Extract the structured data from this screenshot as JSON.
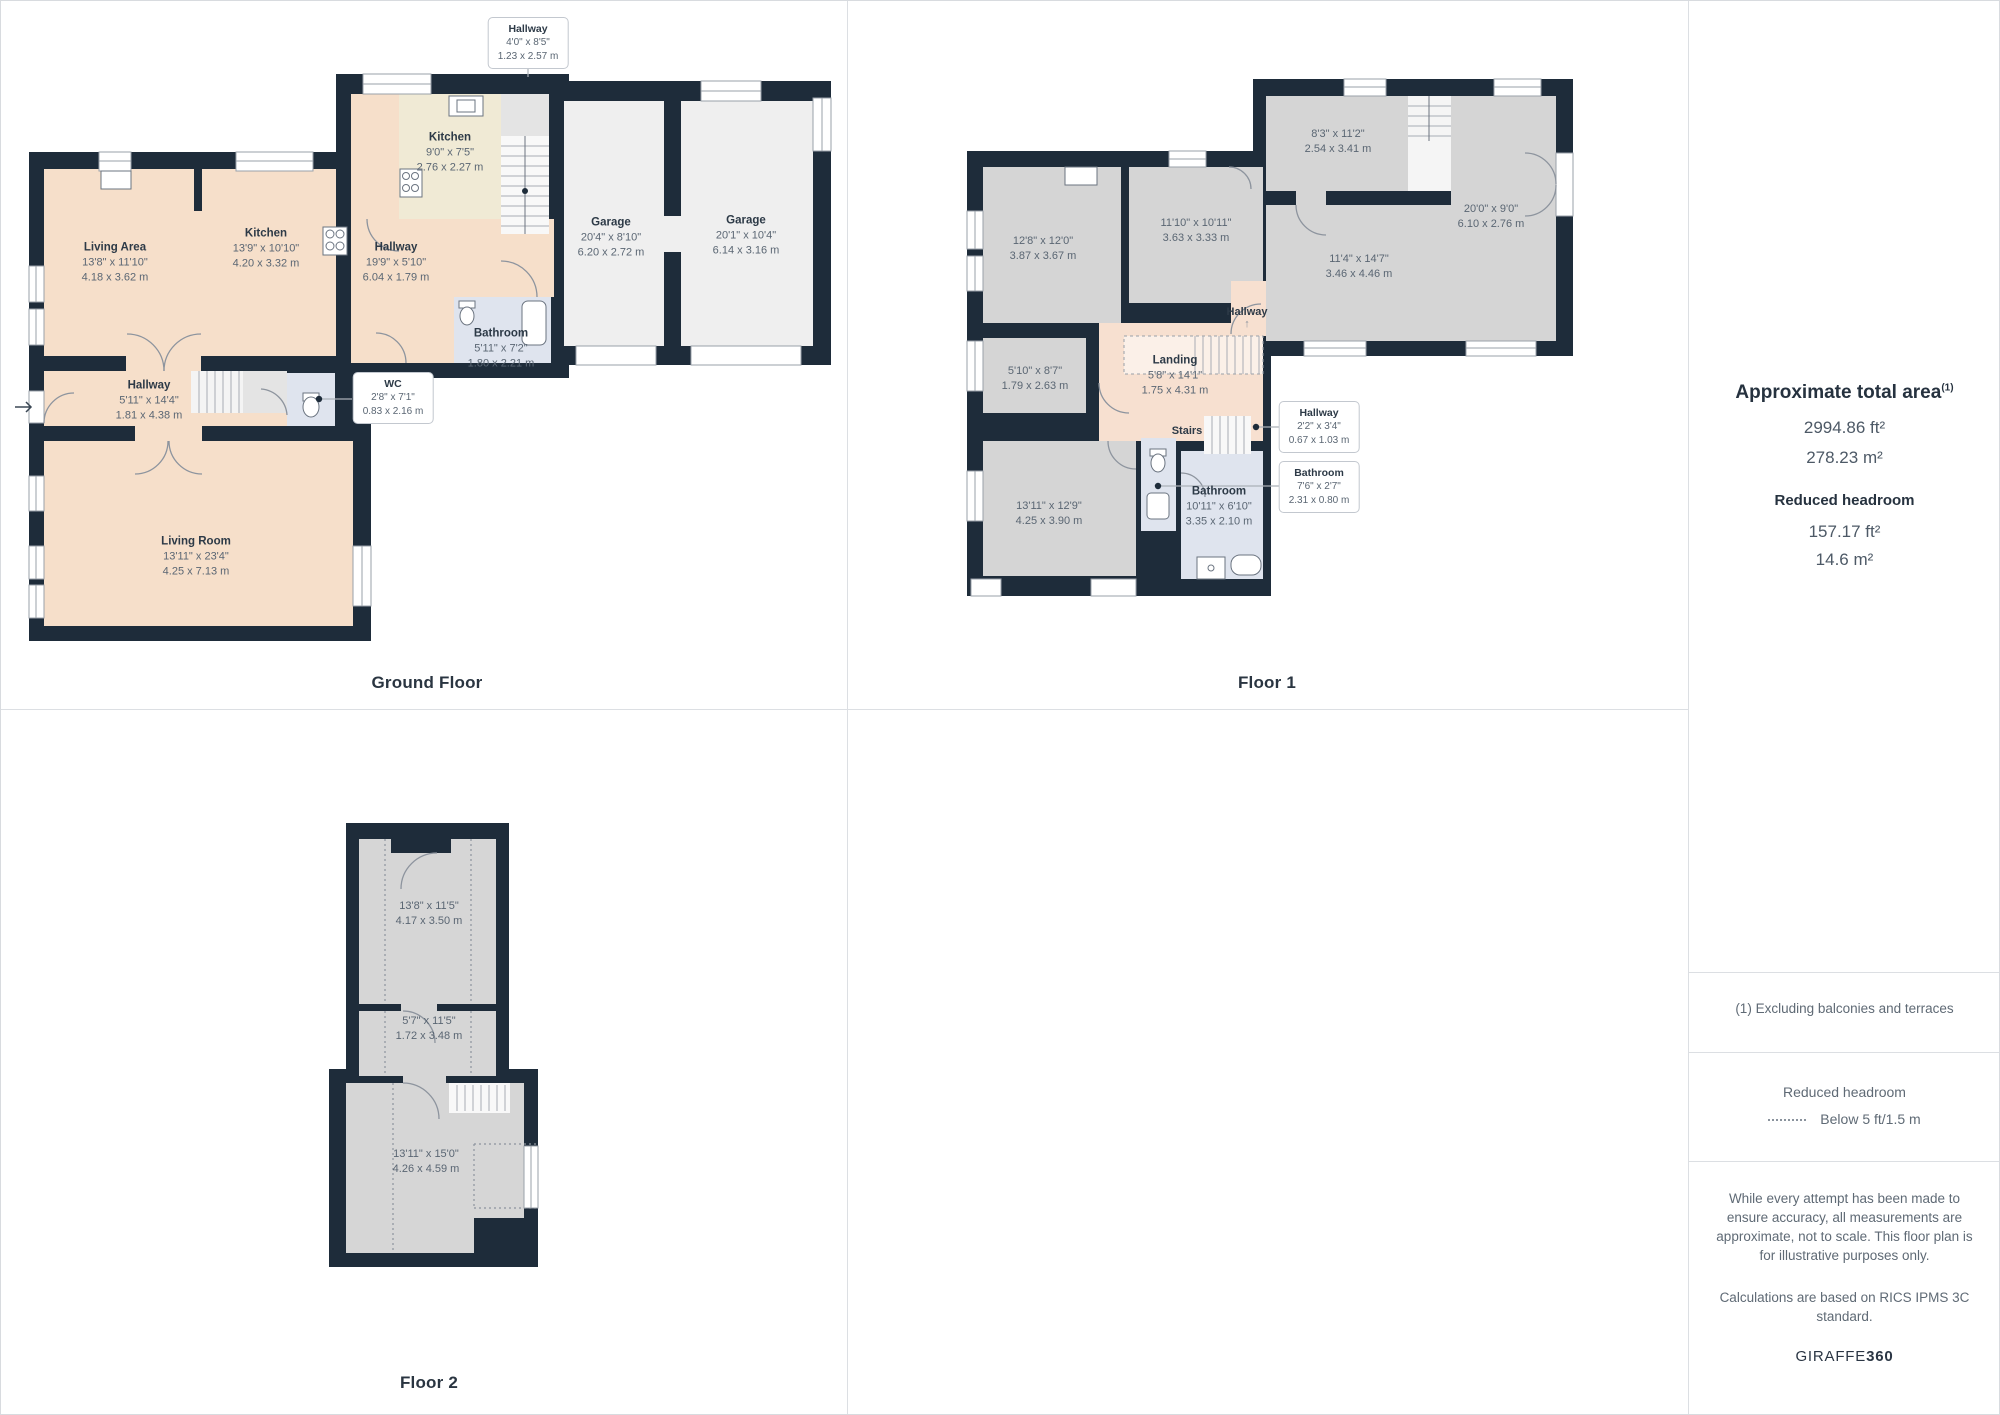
{
  "floors": {
    "ground": {
      "title": "Ground Floor",
      "rooms": [
        {
          "name": "Living Area",
          "ft": "13'8\" x 11'10\"",
          "m": "4.18 x 3.62 m"
        },
        {
          "name": "Kitchen",
          "ft": "13'9\" x 10'10\"",
          "m": "4.20 x 3.32 m"
        },
        {
          "name": "Kitchen",
          "ft": "9'0\" x 7'5\"",
          "m": "2.76 x 2.27 m"
        },
        {
          "name": "Hallway",
          "ft": "19'9\" x 5'10\"",
          "m": "6.04 x 1.79 m"
        },
        {
          "name": "Garage",
          "ft": "20'4\" x 8'10\"",
          "m": "6.20 x 2.72 m"
        },
        {
          "name": "Garage",
          "ft": "20'1\" x 10'4\"",
          "m": "6.14 x 3.16 m"
        },
        {
          "name": "Bathroom",
          "ft": "5'11\" x 7'2\"",
          "m": "1.80 x 2.21 m"
        },
        {
          "name": "Hallway",
          "ft": "5'11\" x 14'4\"",
          "m": "1.81 x 4.38 m"
        },
        {
          "name": "Living Room",
          "ft": "13'11\" x 23'4\"",
          "m": "4.25 x 7.13 m"
        }
      ],
      "callouts": [
        {
          "name": "Hallway",
          "ft": "4'0\" x 8'5\"",
          "m": "1.23 x 2.57 m"
        },
        {
          "name": "WC",
          "ft": "2'8\" x 7'1\"",
          "m": "0.83 x 2.16 m"
        }
      ]
    },
    "floor1": {
      "title": "Floor 1",
      "rooms": [
        {
          "ft": "12'8\" x 12'0\"",
          "m": "3.87 x 3.67 m"
        },
        {
          "ft": "11'10\" x 10'11\"",
          "m": "3.63 x 3.33 m"
        },
        {
          "ft": "8'3\" x 11'2\"",
          "m": "2.54 x 3.41 m"
        },
        {
          "ft": "20'0\" x 9'0\"",
          "m": "6.10 x 2.76 m"
        },
        {
          "ft": "11'4\" x 14'7\"",
          "m": "3.46 x 4.46 m"
        },
        {
          "ft": "5'10\" x 8'7\"",
          "m": "1.79 x 2.63 m"
        },
        {
          "name": "Landing",
          "ft": "5'8\" x 14'1\"",
          "m": "1.75 x 4.31 m"
        },
        {
          "ft": "13'11\" x 12'9\"",
          "m": "4.25 x 3.90 m"
        },
        {
          "name": "Bathroom",
          "ft": "10'11\" x 6'10\"",
          "m": "3.35 x 2.10 m"
        }
      ],
      "labels": {
        "hallway": "Hallway",
        "stairs": "Stairs",
        "arrow": "↑"
      },
      "callouts": [
        {
          "name": "Hallway",
          "ft": "2'2\" x 3'4\"",
          "m": "0.67 x 1.03 m"
        },
        {
          "name": "Bathroom",
          "ft": "7'6\" x 2'7\"",
          "m": "2.31 x 0.80 m"
        }
      ]
    },
    "floor2": {
      "title": "Floor 2",
      "rooms": [
        {
          "ft": "13'8\" x 11'5\"",
          "m": "4.17 x 3.50 m"
        },
        {
          "ft": "5'7\" x 11'5\"",
          "m": "1.72 x 3.48 m"
        },
        {
          "ft": "13'11\" x 15'0\"",
          "m": "4.26 x 4.59 m"
        }
      ]
    }
  },
  "sidebar": {
    "total_area_title": "Approximate total area",
    "total_area_note_ref": "(1)",
    "total_area_ft": "2994.86 ft²",
    "total_area_m": "278.23 m²",
    "reduced_headroom_title": "Reduced headroom",
    "reduced_headroom_ft": "157.17 ft²",
    "reduced_headroom_m": "14.6 m²",
    "footnote": "(1) Excluding balconies and terraces",
    "legend_title": "Reduced headroom",
    "legend_item": "Below 5 ft/1.5 m",
    "disclaimer1": "While every attempt has been made to ensure accuracy, all measurements are approximate, not to scale. This floor plan is for illustrative purposes only.",
    "disclaimer2": "Calculations are based on RICS IPMS 3C standard.",
    "brand_regular": "GIRAFFE",
    "brand_bold": "360"
  }
}
